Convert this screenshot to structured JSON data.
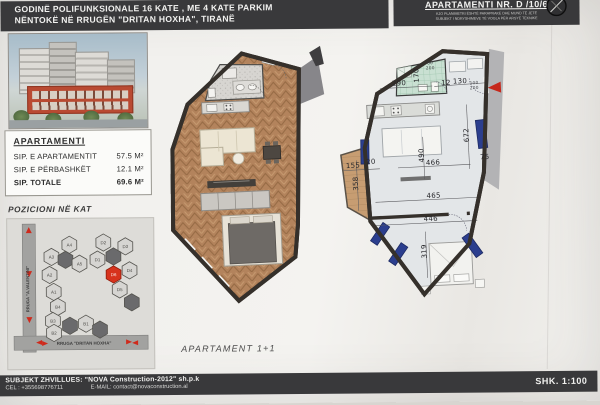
{
  "header": {
    "title_line1": "GODINË POLIFUNKSIONALE 16 KATE , ME 4 KATE PARKIM",
    "title_line2": "NËNTOKË NË RRUGËN \"DRITAN HOXHA\", TIRANË",
    "apartment_label": "APARTAMENTI NR. D /10/6",
    "disclaimer_line1": "KJO PLANIMETRI ËSHTË PARAPRAKE DHE MUND TË JETË",
    "disclaimer_line2": "SUBJEKT I NDRYSHIMEVE TË VOGLA PËR ARSYE TEKNIKE"
  },
  "sidebar": {
    "info_title": "APARTAMENTI",
    "rows": [
      {
        "label": "SIP. E APARTAMENTIT",
        "value": "57.5 M²"
      },
      {
        "label": "SIP. E PËRBASHKËT",
        "value": "12.1 M²"
      },
      {
        "label": "SIP. TOTALE",
        "value": "69.6 M²"
      }
    ],
    "position_title": "POZICIONI NË KAT",
    "street_left": "RRUGA \"A.VALENTINI\"",
    "street_bottom": "RRUGA \"DRITAN HOXHA\"",
    "units": [
      {
        "id": "A4",
        "x": 62,
        "y": 26
      },
      {
        "id": "D2",
        "x": 96,
        "y": 24
      },
      {
        "id": "D3",
        "x": 118,
        "y": 28
      },
      {
        "id": "A3",
        "x": 44,
        "y": 38
      },
      {
        "id": "",
        "x": 58,
        "y": 41,
        "dark": true
      },
      {
        "id": "A5",
        "x": 72,
        "y": 45
      },
      {
        "id": "D1",
        "x": 90,
        "y": 41
      },
      {
        "id": "",
        "x": 106,
        "y": 38,
        "dark": true
      },
      {
        "id": "D4",
        "x": 122,
        "y": 52
      },
      {
        "id": "D6",
        "x": 106,
        "y": 56,
        "red": true
      },
      {
        "id": "A2",
        "x": 42,
        "y": 56
      },
      {
        "id": "D5",
        "x": 112,
        "y": 71
      },
      {
        "id": "",
        "x": 124,
        "y": 84,
        "dark": true
      },
      {
        "id": "A1",
        "x": 46,
        "y": 73
      },
      {
        "id": "B4",
        "x": 50,
        "y": 88
      },
      {
        "id": "B3",
        "x": 45,
        "y": 102
      },
      {
        "id": "",
        "x": 62,
        "y": 107,
        "dark": true
      },
      {
        "id": "B1",
        "x": 78,
        "y": 105
      },
      {
        "id": "B2",
        "x": 46,
        "y": 114
      },
      {
        "id": "",
        "x": 92,
        "y": 111,
        "dark": true
      }
    ]
  },
  "plans": {
    "caption": "APARTAMENT  1+1",
    "right_dims": [
      {
        "t": "290",
        "x": 67,
        "y": 38
      },
      {
        "t": "170",
        "x": 85,
        "y": 31,
        "v": true
      },
      {
        "t": "12",
        "x": 114,
        "y": 40
      },
      {
        "t": "130",
        "x": 128,
        "y": 39
      },
      {
        "t": "100",
        "x": 142,
        "y": 41,
        "s": true
      },
      {
        "t": "200",
        "x": 142,
        "y": 46,
        "s": true
      },
      {
        "t": "80",
        "x": 99,
        "y": 19,
        "s": true
      },
      {
        "t": "200",
        "x": 99,
        "y": 24,
        "s": true
      },
      {
        "t": "672",
        "x": 132,
        "y": 93,
        "v": true
      },
      {
        "t": "155",
        "x": 17,
        "y": 118
      },
      {
        "t": "20",
        "x": 35,
        "y": 115
      },
      {
        "t": "358",
        "x": 19,
        "y": 136,
        "v": true
      },
      {
        "t": "490",
        "x": 86,
        "y": 111,
        "v": true
      },
      {
        "t": "466",
        "x": 97,
        "y": 119
      },
      {
        "t": "75",
        "x": 149,
        "y": 116
      },
      {
        "t": "465",
        "x": 96,
        "y": 152
      },
      {
        "t": "446",
        "x": 92,
        "y": 175
      },
      {
        "t": "319",
        "x": 84,
        "y": 207,
        "v": true
      }
    ]
  },
  "footer": {
    "developer": "SUBJEKT ZHVILLUES: \"NOVA Construction-2012\" sh.p.k",
    "phone": "CEL : +355698776711",
    "email": "E-MAIL: contact@novaconstruction.al",
    "scale": "SHK. 1:100"
  }
}
